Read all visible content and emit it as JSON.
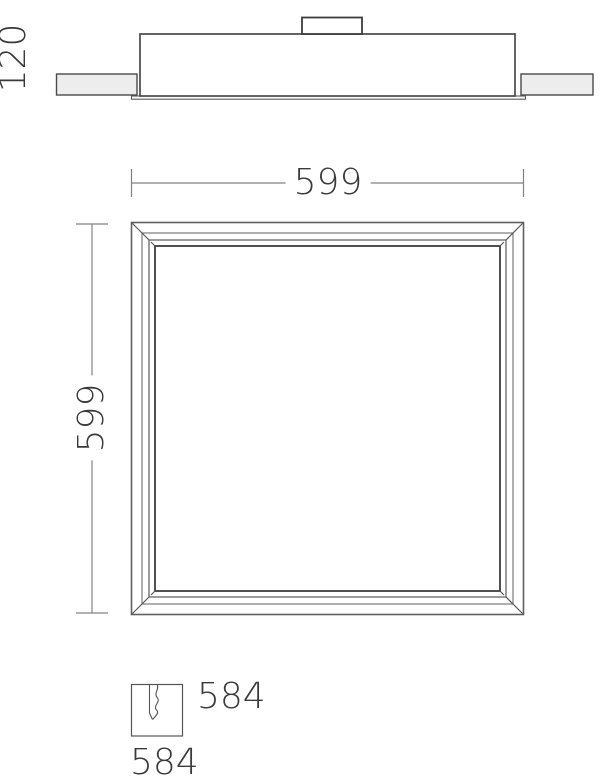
{
  "colors": {
    "outline": "#4a4a4a",
    "inner_frame": "#3d3d3d",
    "dimension_line": "#828282",
    "tile_fill": "#ededed",
    "text": "#3a3a3a",
    "background": "#ffffff"
  },
  "side_view": {
    "depth_label": "120"
  },
  "plan_view": {
    "width_label": "599",
    "height_label": "599"
  },
  "cutout": {
    "width_label": "584",
    "height_label": "584"
  }
}
